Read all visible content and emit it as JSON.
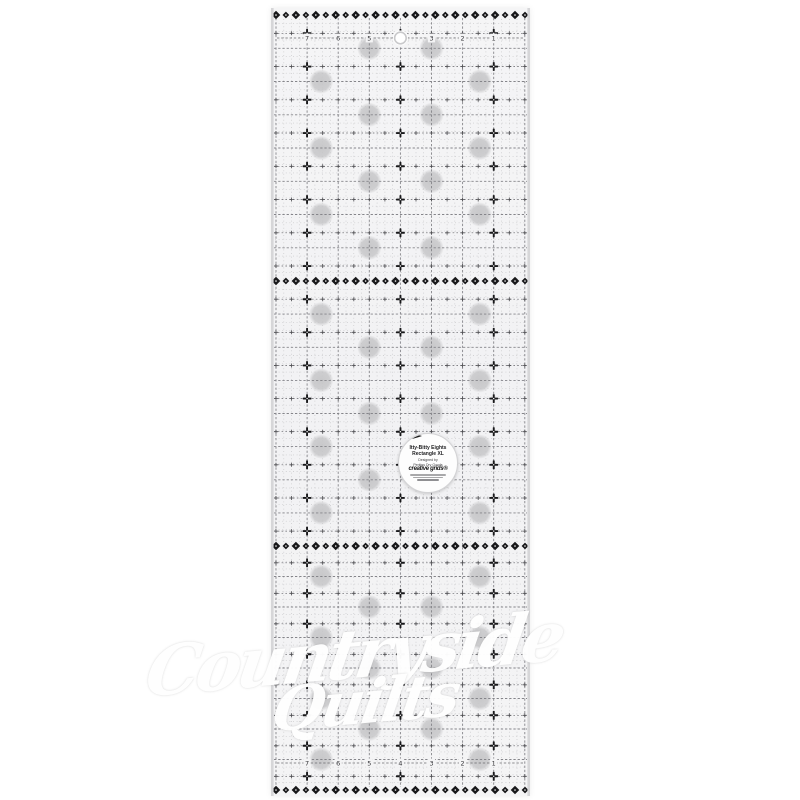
{
  "page": {
    "background": "#ffffff"
  },
  "ruler": {
    "description": "transparent quilting ruler with eighth-inch grid",
    "numbers_top": [
      "7",
      "6",
      "5",
      "4",
      "3",
      "2",
      "1"
    ],
    "numbers_bottom": [
      "7",
      "6",
      "5",
      "4",
      "3",
      "2",
      "1"
    ],
    "colors": {
      "body": "#f4f4f5",
      "markings": "#2c2c2e",
      "ornament": "#18181a",
      "grip_dot": "#c6c6c8",
      "edge": "#d6d6d8"
    }
  },
  "label": {
    "line1": "Itty-Bitty Eights",
    "line2": "Rectangle XL",
    "designed_by": "Designed by",
    "designer": "Perkins Dry Goods",
    "brand": "creative grids®"
  },
  "watermark": {
    "line1": "Countryside",
    "line2": "Quilts"
  }
}
